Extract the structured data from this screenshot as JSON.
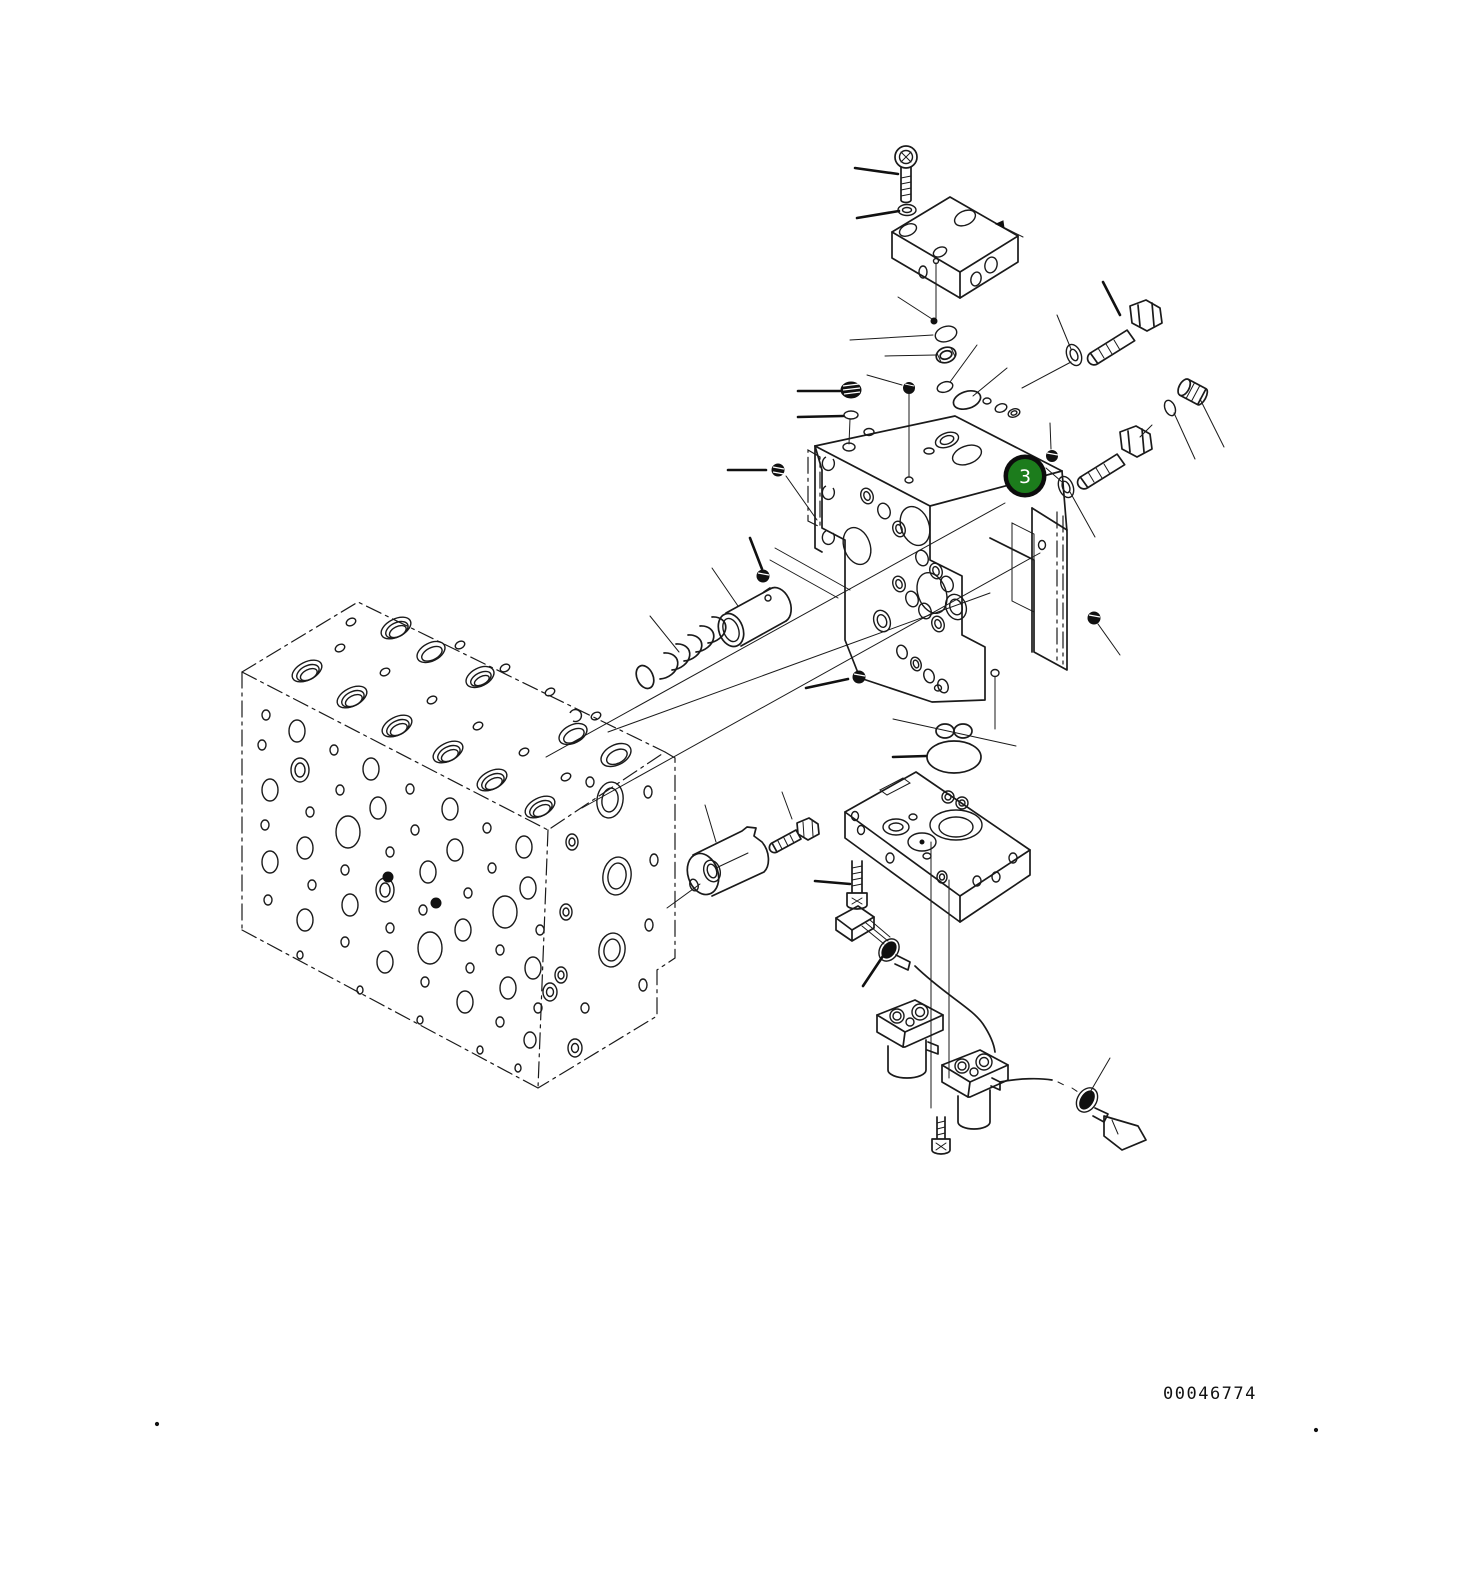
{
  "figure": {
    "callout": {
      "label": "3"
    },
    "drawing_number": "00046774"
  },
  "colors": {
    "callout_fill": "#1c7c1c",
    "callout_ring": "#0d0d0d",
    "callout_text": "#ffffff",
    "line": "#1a1a1a",
    "background": "#ffffff"
  }
}
